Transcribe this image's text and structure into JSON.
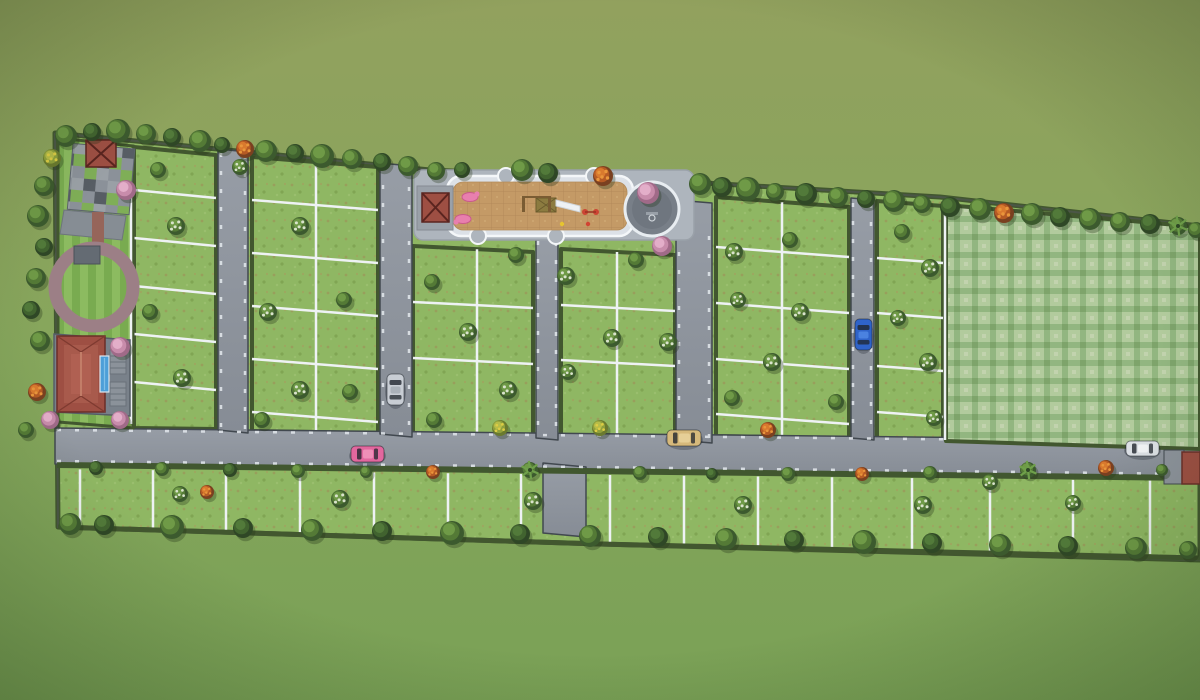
{
  "scene": {
    "description": "Aerial top-down 3D render of a residential plotted land development (site layout master plan) surrounded by open grassland, with internal roads, fenced plots, amenities and parked cars",
    "no_visible_text": true
  },
  "palette": {
    "background_top": "#92a15e",
    "background_bottom": "#7aa156",
    "plot_grass": "#8fb763",
    "hedge_dark": "#42572f",
    "road": "#8d939c",
    "road_edge": "#41484f",
    "curb_stone": "#dfe4e9",
    "fence_white": "#eef2f4",
    "field_plaid_light": "#b2cb9d",
    "field_plaid_dark": "#7ea46b",
    "sand": "#c49a66",
    "platform_concrete": "#dce1e7",
    "walkway": "#aeb5bd",
    "court_gray": "#787f88",
    "track_mauve": "#9c7f86",
    "roof_red": "#9e4f43",
    "pool_blue": "#4d9fd8",
    "deck_gray": "#79818a",
    "checker_gray": "#8b9199",
    "checker_dark": "#575d64",
    "checker_green": "#7fae57",
    "tree_pink": "#d99cc0",
    "tree_orange": "#cf6a2b",
    "bloom_white": "#d9e3cc"
  },
  "amenities": [
    {
      "id": "clubhouse",
      "label": "clubhouse with red hip roof and side deck"
    },
    {
      "id": "swimming-pool",
      "label": "blue lap pool beside clubhouse"
    },
    {
      "id": "entry-gazebo",
      "label": "red-roof gazebo on checkered paver plaza"
    },
    {
      "id": "checkered-plaza",
      "label": "gray/green checkered paver plaza"
    },
    {
      "id": "walking-track",
      "label": "circular walking track around striped lawn"
    },
    {
      "id": "kids-play-area",
      "label": "sand play area with swings, slide and pink play sculptures"
    },
    {
      "id": "play-gazebo",
      "label": "red-roof gazebo beside play area"
    },
    {
      "id": "round-court",
      "label": "circular paved court with hoop"
    },
    {
      "id": "open-lawn",
      "label": "large checker-mowed open lawn parcel on the right"
    },
    {
      "id": "gate-cabin",
      "label": "small red-roof cabin at right road exit"
    }
  ],
  "site": {
    "plot_columns": [
      {
        "id": "A",
        "x1": 134,
        "x2": 216,
        "yt1": 147,
        "yt2": 155,
        "yb1": 428,
        "yb2": 429,
        "vdiv": [],
        "hdivs": [
          190,
          238,
          286,
          334,
          382
        ]
      },
      {
        "id": "B",
        "x1": 252,
        "x2": 378,
        "yt1": 157,
        "yt2": 167,
        "yb1": 431,
        "yb2": 433,
        "vdiv": [
          316
        ],
        "hdivs": [
          200,
          253,
          306,
          359,
          412
        ]
      },
      {
        "id": "C",
        "x1": 413,
        "x2": 533,
        "yt1": 246,
        "yt2": 252,
        "yb1": 435,
        "yb2": 437,
        "vdiv": [
          477
        ],
        "hdivs": [
          302,
          358
        ]
      },
      {
        "id": "D",
        "x1": 561,
        "x2": 675,
        "yt1": 249,
        "yt2": 255,
        "yb1": 439,
        "yb2": 440,
        "vdiv": [
          617
        ],
        "hdivs": [
          305,
          360
        ]
      },
      {
        "id": "E",
        "x1": 716,
        "x2": 849,
        "yt1": 197,
        "yt2": 207,
        "yb1": 436,
        "yb2": 438,
        "vdiv": [
          782
        ],
        "hdivs": [
          247,
          303,
          359,
          414
        ]
      },
      {
        "id": "F",
        "x1": 877,
        "x2": 943,
        "yt1": 201,
        "yt2": 206,
        "yb1": 439,
        "yb2": 440,
        "vdiv": [],
        "hdivs": [
          258,
          313,
          366,
          412
        ]
      }
    ],
    "bottom_row_divider_xs": [
      80,
      153,
      226,
      300,
      374,
      448,
      521,
      610,
      684,
      758,
      832,
      912,
      990,
      1073,
      1150
    ],
    "roads": {
      "main": "horizontal road across full site near bottom",
      "verticals": 5,
      "south_stub": "short entry stub below main road at center"
    }
  },
  "vehicles": [
    {
      "id": "car-silver",
      "color": "#c8cdd4",
      "accent": "#aab1b9",
      "x": 387,
      "y": 374,
      "w": 17,
      "h": 31,
      "orientation": "vertical"
    },
    {
      "id": "car-pink",
      "color": "#e2679e",
      "accent": "#ef8fb8",
      "x": 351,
      "y": 446,
      "w": 33,
      "h": 16,
      "orientation": "horizontal"
    },
    {
      "id": "car-gold",
      "color": "#d6b97b",
      "accent": "#e6cf97",
      "x": 667,
      "y": 430,
      "w": 34,
      "h": 16,
      "orientation": "horizontal"
    },
    {
      "id": "car-blue",
      "color": "#2f63c9",
      "accent": "#4b82e0",
      "x": 855,
      "y": 319,
      "w": 17,
      "h": 31,
      "orientation": "vertical"
    },
    {
      "id": "car-white",
      "color": "#dde1e6",
      "accent": "#f2f4f7",
      "x": 1126,
      "y": 441,
      "w": 33,
      "h": 15,
      "orientation": "horizontal"
    }
  ],
  "trees": [
    [
      66,
      136,
      11,
      "g"
    ],
    [
      92,
      132,
      9,
      "d"
    ],
    [
      118,
      131,
      12,
      "g"
    ],
    [
      146,
      134,
      10,
      "g"
    ],
    [
      172,
      137,
      9,
      "d"
    ],
    [
      200,
      141,
      11,
      "g"
    ],
    [
      222,
      145,
      8,
      "d"
    ],
    [
      245,
      149,
      9,
      "o"
    ],
    [
      240,
      167,
      8,
      "w"
    ],
    [
      266,
      151,
      11,
      "g"
    ],
    [
      295,
      153,
      9,
      "d"
    ],
    [
      322,
      156,
      12,
      "g"
    ],
    [
      352,
      159,
      10,
      "g"
    ],
    [
      382,
      162,
      9,
      "d"
    ],
    [
      408,
      166,
      10,
      "g"
    ],
    [
      436,
      171,
      9,
      "g"
    ],
    [
      462,
      170,
      8,
      "d"
    ],
    [
      522,
      170,
      11,
      "g"
    ],
    [
      548,
      173,
      10,
      "d"
    ],
    [
      603,
      176,
      10,
      "o"
    ],
    [
      648,
      193,
      11,
      "p"
    ],
    [
      662,
      246,
      10,
      "p"
    ],
    [
      700,
      184,
      11,
      "g"
    ],
    [
      722,
      187,
      10,
      "d"
    ],
    [
      748,
      189,
      12,
      "g"
    ],
    [
      775,
      192,
      9,
      "g"
    ],
    [
      806,
      194,
      11,
      "d"
    ],
    [
      838,
      197,
      10,
      "g"
    ],
    [
      866,
      199,
      9,
      "d"
    ],
    [
      894,
      201,
      11,
      "g"
    ],
    [
      922,
      204,
      9,
      "g"
    ],
    [
      950,
      207,
      10,
      "d"
    ],
    [
      980,
      209,
      11,
      "g"
    ],
    [
      1004,
      213,
      10,
      "o"
    ],
    [
      1032,
      214,
      11,
      "g"
    ],
    [
      1060,
      217,
      10,
      "d"
    ],
    [
      1090,
      219,
      11,
      "g"
    ],
    [
      1120,
      222,
      10,
      "g"
    ],
    [
      1150,
      224,
      10,
      "d"
    ],
    [
      1178,
      226,
      9,
      "m"
    ],
    [
      1196,
      230,
      8,
      "g"
    ],
    [
      52,
      158,
      9,
      "y"
    ],
    [
      44,
      186,
      10,
      "g"
    ],
    [
      38,
      216,
      11,
      "g"
    ],
    [
      44,
      247,
      9,
      "d"
    ],
    [
      36,
      278,
      10,
      "g"
    ],
    [
      31,
      310,
      9,
      "d"
    ],
    [
      40,
      341,
      10,
      "g"
    ],
    [
      37,
      392,
      9,
      "o"
    ],
    [
      50,
      420,
      9,
      "p"
    ],
    [
      26,
      430,
      8,
      "g"
    ],
    [
      126,
      190,
      10,
      "p"
    ],
    [
      120,
      347,
      10,
      "p"
    ],
    [
      120,
      420,
      9,
      "p"
    ],
    [
      158,
      170,
      8,
      "g"
    ],
    [
      176,
      226,
      9,
      "w"
    ],
    [
      150,
      312,
      8,
      "g"
    ],
    [
      182,
      378,
      9,
      "w"
    ],
    [
      300,
      226,
      9,
      "w"
    ],
    [
      268,
      312,
      9,
      "w"
    ],
    [
      344,
      300,
      8,
      "g"
    ],
    [
      300,
      390,
      9,
      "w"
    ],
    [
      350,
      392,
      8,
      "g"
    ],
    [
      262,
      420,
      8,
      "g"
    ],
    [
      432,
      282,
      8,
      "g"
    ],
    [
      468,
      332,
      9,
      "w"
    ],
    [
      508,
      390,
      9,
      "w"
    ],
    [
      516,
      255,
      8,
      "g"
    ],
    [
      434,
      420,
      8,
      "g"
    ],
    [
      500,
      428,
      8,
      "y"
    ],
    [
      566,
      276,
      9,
      "w"
    ],
    [
      612,
      338,
      9,
      "w"
    ],
    [
      568,
      372,
      8,
      "w"
    ],
    [
      636,
      260,
      8,
      "g"
    ],
    [
      668,
      342,
      9,
      "w"
    ],
    [
      600,
      428,
      8,
      "y"
    ],
    [
      734,
      252,
      9,
      "w"
    ],
    [
      790,
      240,
      8,
      "g"
    ],
    [
      738,
      300,
      8,
      "w"
    ],
    [
      800,
      312,
      9,
      "w"
    ],
    [
      772,
      362,
      9,
      "w"
    ],
    [
      836,
      402,
      8,
      "g"
    ],
    [
      768,
      430,
      8,
      "o"
    ],
    [
      732,
      398,
      8,
      "g"
    ],
    [
      902,
      232,
      8,
      "g"
    ],
    [
      930,
      268,
      9,
      "w"
    ],
    [
      898,
      318,
      8,
      "w"
    ],
    [
      928,
      362,
      9,
      "w"
    ],
    [
      934,
      418,
      8,
      "w"
    ],
    [
      96,
      468,
      7,
      "d"
    ],
    [
      162,
      469,
      7,
      "g"
    ],
    [
      230,
      470,
      7,
      "d"
    ],
    [
      298,
      471,
      7,
      "g"
    ],
    [
      366,
      472,
      6,
      "g"
    ],
    [
      433,
      472,
      7,
      "o"
    ],
    [
      530,
      470,
      8,
      "m"
    ],
    [
      640,
      473,
      7,
      "g"
    ],
    [
      712,
      474,
      6,
      "d"
    ],
    [
      788,
      474,
      7,
      "g"
    ],
    [
      862,
      474,
      7,
      "o"
    ],
    [
      930,
      473,
      7,
      "g"
    ],
    [
      1028,
      470,
      8,
      "m"
    ],
    [
      1106,
      468,
      8,
      "o"
    ],
    [
      1162,
      470,
      6,
      "g"
    ],
    [
      180,
      494,
      8,
      "w"
    ],
    [
      207,
      492,
      7,
      "o"
    ],
    [
      340,
      499,
      9,
      "w"
    ],
    [
      533,
      501,
      9,
      "w"
    ],
    [
      743,
      505,
      9,
      "w"
    ],
    [
      923,
      505,
      9,
      "w"
    ],
    [
      990,
      482,
      8,
      "w"
    ],
    [
      1073,
      503,
      8,
      "w"
    ],
    [
      70,
      524,
      11,
      "g"
    ],
    [
      104,
      525,
      10,
      "d"
    ],
    [
      172,
      527,
      12,
      "g"
    ],
    [
      243,
      528,
      10,
      "d"
    ],
    [
      312,
      530,
      11,
      "g"
    ],
    [
      382,
      531,
      10,
      "d"
    ],
    [
      452,
      533,
      12,
      "g"
    ],
    [
      520,
      534,
      10,
      "d"
    ],
    [
      590,
      536,
      11,
      "g"
    ],
    [
      658,
      537,
      10,
      "d"
    ],
    [
      726,
      539,
      11,
      "g"
    ],
    [
      794,
      540,
      10,
      "d"
    ],
    [
      864,
      542,
      12,
      "g"
    ],
    [
      932,
      543,
      10,
      "d"
    ],
    [
      1000,
      545,
      11,
      "g"
    ],
    [
      1068,
      546,
      10,
      "d"
    ],
    [
      1136,
      548,
      11,
      "g"
    ],
    [
      1188,
      550,
      9,
      "g"
    ]
  ]
}
